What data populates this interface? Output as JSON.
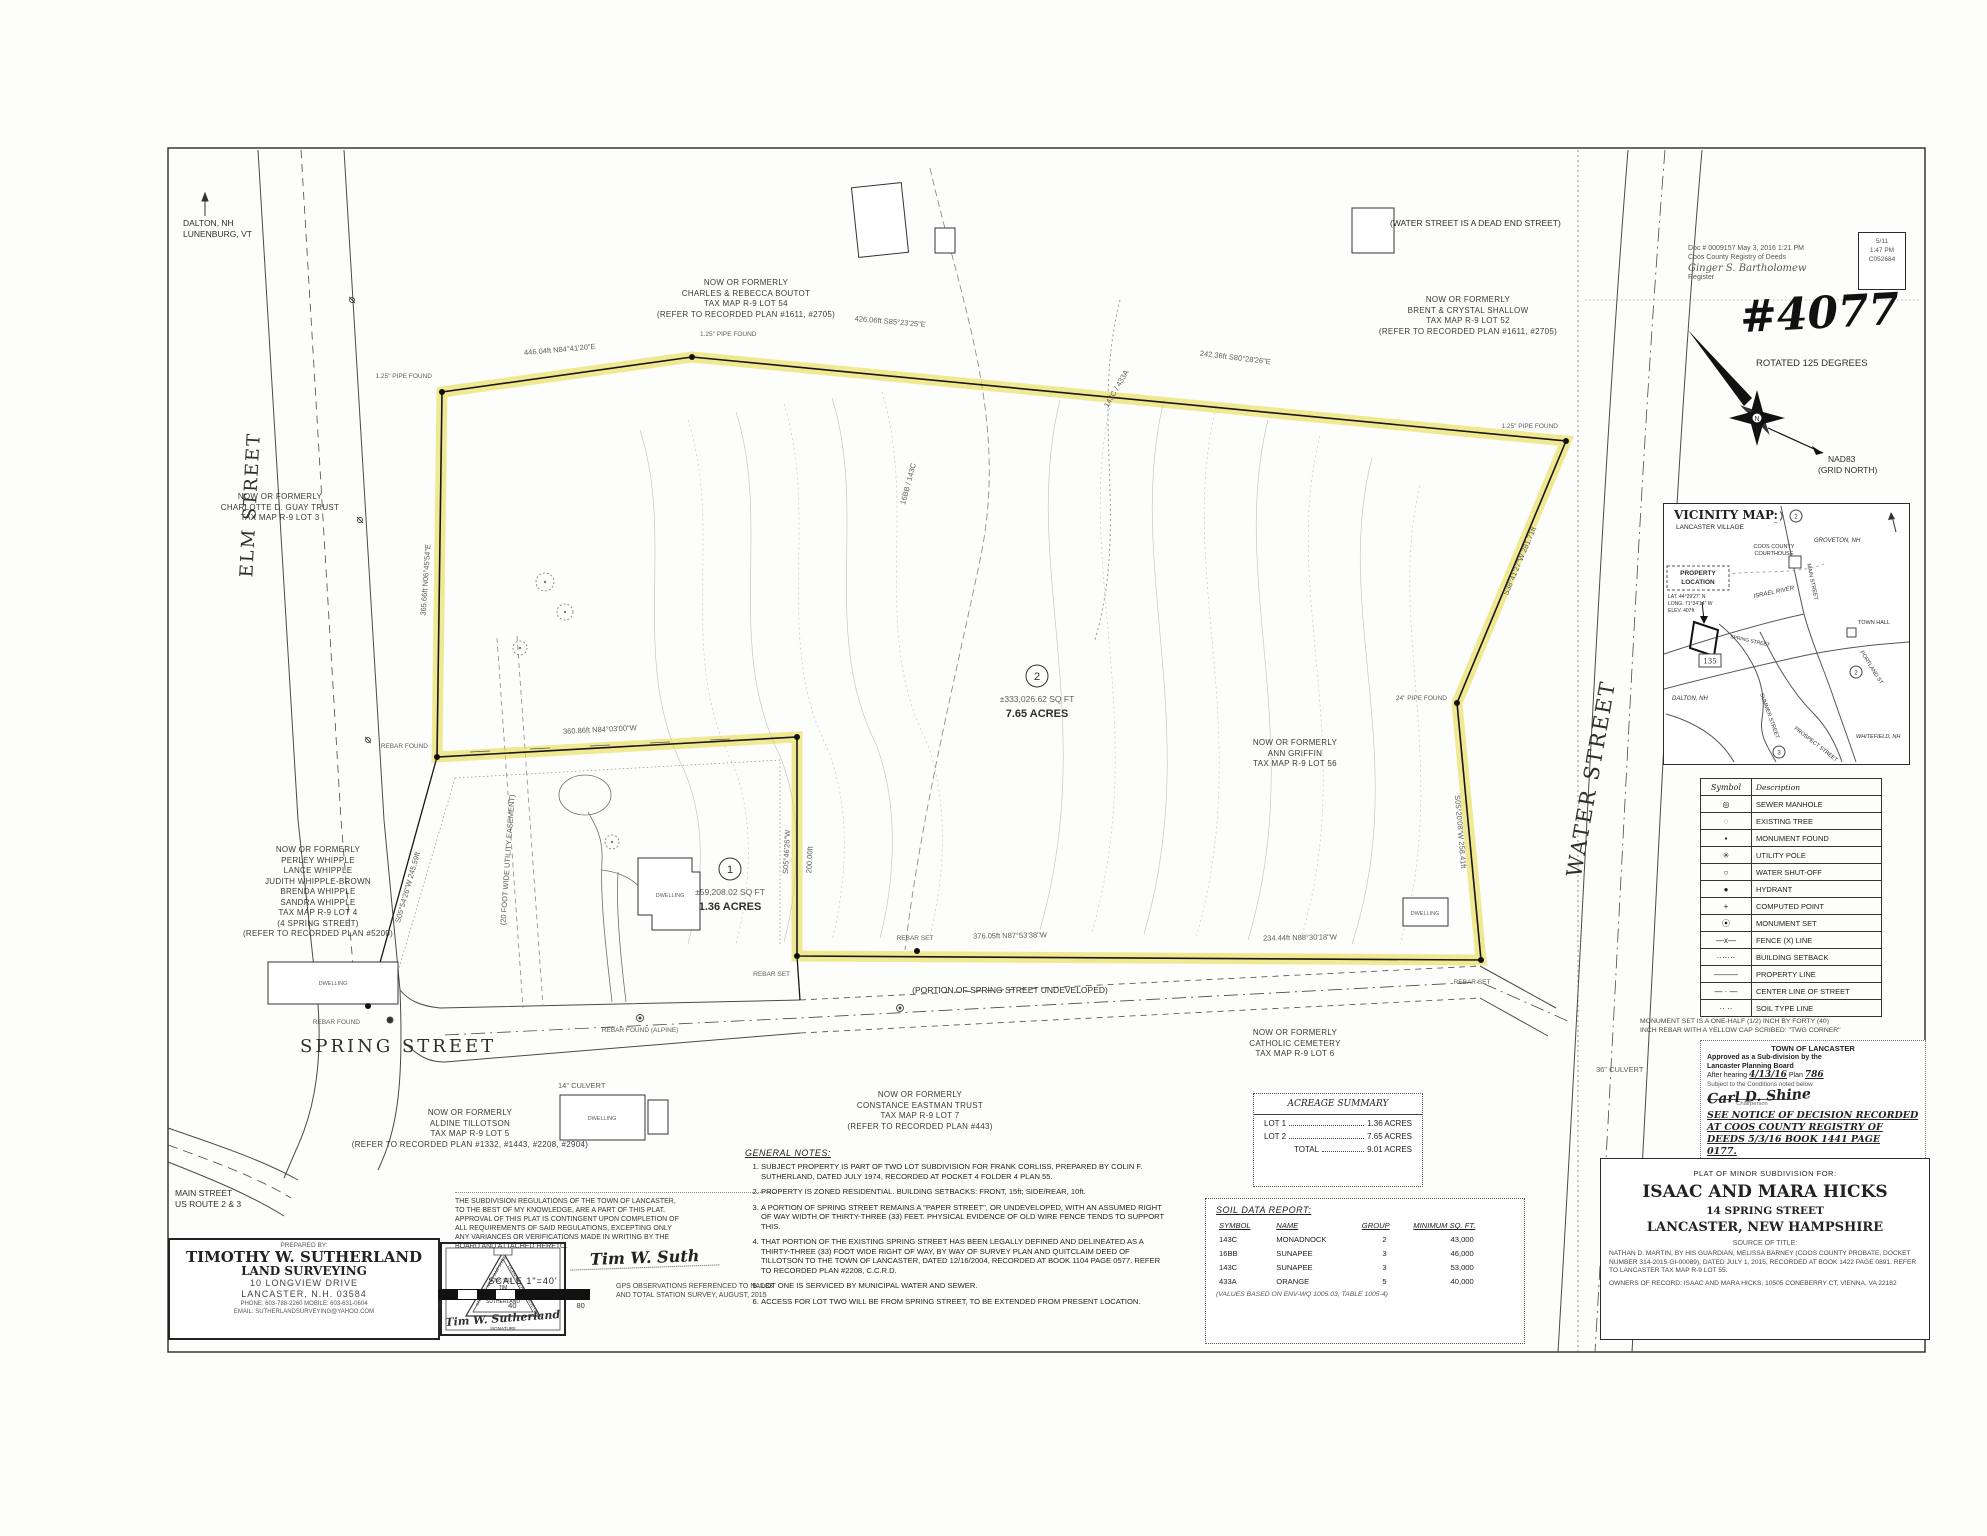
{
  "colors": {
    "boundary_highlight": "#e7d83a",
    "ink": "#1d1d1d"
  },
  "sheet": {
    "number": "#4077",
    "rotation_note": "ROTATED 125 DEGREES",
    "grid_north_1": "NAD83",
    "grid_north_2": "(GRID NORTH)",
    "dead_end_note": "(WATER STREET IS A DEAD END STREET)"
  },
  "stamp": {
    "line1": "Doc # 0009157   May 3, 2016 1:21 PM",
    "line2": "Coos County Registry of Deeds",
    "signature": "Ginger S. Bartholomew",
    "line3": "Register",
    "box": [
      "5/11",
      "1:47 PM",
      "C052684"
    ]
  },
  "map": {
    "streets": {
      "elm": "ELM STREET",
      "water": "WATER STREET",
      "spring": "SPRING STREET",
      "main1": "MAIN STREET",
      "main2": "US ROUTE 2 & 3",
      "spring_undeveloped": "(PORTION OF SPRING STREET UNDEVELOPED)"
    },
    "off_map": {
      "dalton": "DALTON, NH",
      "lunenburg": "LUNENBURG, VT"
    },
    "lot1": {
      "num": "1",
      "sqft": "±59,208.02 SQ FT",
      "acres": "1.36 ACRES"
    },
    "lot2": {
      "num": "2",
      "sqft": "±333,026.62 SQ FT",
      "acres": "7.65 ACRES"
    },
    "easement": "(20 FOOT WIDE UTILITY EASEMENT)",
    "culvert_west": "14\" CULVERT",
    "culvert_east": "36\" CULVERT",
    "soil_label_1": "16BB / 143C",
    "soil_label_2": "143C / 433A",
    "dwelling": "DWELLING",
    "monuments": {
      "a": "1.25\" PIPE FOUND",
      "b": "1.25\" PIPE FOUND",
      "c": "1.25\" PIPE FOUND",
      "d": "24\" PIPE FOUND",
      "e": "REBAR SET",
      "f": "REBAR SET",
      "g": "REBAR SET",
      "i": "REBAR FOUND",
      "j": "REBAR FOUND",
      "mid": "REBAR FOUND (ALPINE)"
    },
    "bearings": {
      "b1": "446.04ft   N84°41'20\"E",
      "b2": "426.06ft   S85°23'25\"E",
      "b3": "242.36ft   S80°28'26\"E",
      "b4": "S38°41'27\"W   281.71ft",
      "b5": "S05°20'08\"W   258.41ft",
      "b6": "234.44ft   N88°30'18\"W",
      "b7": "376.05ft   N87°53'38\"W",
      "b8": "S05°46'26\"W",
      "b9": "200.00ft",
      "b10": "360.86ft   N84°03'00\"W",
      "b11": "365.66ft   N06°45'54\"E",
      "b12": "S05°54'26\"W   245.59ft"
    },
    "neighbors": {
      "guay": [
        "NOW OR FORMERLY",
        "CHARLOTTE D. GUAY TRUST",
        "TAX MAP R-9 LOT 3"
      ],
      "whipple": [
        "NOW OR FORMERLY",
        "PERLEY WHIPPLE",
        "LANCE WHIPPLE",
        "JUDITH WHIPPLE-BROWN",
        "BRENDA WHIPPLE",
        "SANDRA WHIPPLE",
        "TAX MAP R-9 LOT 4",
        "(4 SPRING STREET)",
        "(REFER TO RECORDED PLAN #5200)"
      ],
      "boutot": [
        "NOW OR FORMERLY",
        "CHARLES & REBECCA BOUTOT",
        "TAX MAP R-9 LOT 54",
        "(REFER TO RECORDED PLAN #1611, #2705)"
      ],
      "shallow": [
        "NOW OR FORMERLY",
        "BRENT & CRYSTAL SHALLOW",
        "TAX MAP R-9 LOT 52",
        "(REFER TO RECORDED PLAN #1611, #2705)"
      ],
      "griffin": [
        "NOW OR FORMERLY",
        "ANN GRIFFIN",
        "TAX MAP R-9 LOT 56"
      ],
      "cemetery": [
        "NOW OR FORMERLY",
        "CATHOLIC CEMETERY",
        "TAX MAP R-9 LOT 6"
      ],
      "eastman": [
        "NOW OR FORMERLY",
        "CONSTANCE EASTMAN TRUST",
        "TAX MAP R-9 LOT 7",
        "(REFER TO RECORDED PLAN #443)"
      ],
      "tillotson": [
        "NOW OR FORMERLY",
        "ALDINE TILLOTSON",
        "TAX MAP R-9 LOT 5",
        "(REFER TO RECORDED PLAN #1332, #1443, #2208, #2904)"
      ]
    }
  },
  "vicinity": {
    "title": "VICINITY MAP:",
    "subtitle": "LANCASTER VILLAGE",
    "groveton": "GROVETON, NH",
    "courthouse1": "COOS COUNTY",
    "courthouse2": "COURTHOUSE",
    "river": "ISRAEL RIVER",
    "main_street": "MAIN STREET",
    "town_hall": "TOWN HALL",
    "portland": "PORTLAND ST",
    "prospect": "PROSPECT STREET",
    "summer": "SUMMER STREET",
    "whitefield": "WHITEFIELD, NH",
    "dalton": "DALTON, NH",
    "route135": "135",
    "route3": "3",
    "route2": "2",
    "property1": "PROPERTY",
    "property2": "LOCATION",
    "lat": "LAT. 44°29'27\" N",
    "long": "LONG. 71°34'14\" W",
    "elev": "ELEV. 407ft",
    "spring_st": "SPRING STREET"
  },
  "legend": {
    "header": [
      "Symbol",
      "Description"
    ],
    "rows": [
      {
        "sym": "◎",
        "desc": "SEWER MANHOLE"
      },
      {
        "sym": "◌",
        "desc": "EXISTING TREE"
      },
      {
        "sym": "▪",
        "desc": "MONUMENT FOUND"
      },
      {
        "sym": "✳",
        "desc": "UTILITY POLE"
      },
      {
        "sym": "○",
        "desc": "WATER SHUT-OFF"
      },
      {
        "sym": "●",
        "desc": "HYDRANT"
      },
      {
        "sym": "+",
        "desc": "COMPUTED POINT"
      },
      {
        "sym": "⦿",
        "desc": "MONUMENT SET"
      },
      {
        "sym": "—x—",
        "desc": "FENCE (X) LINE"
      },
      {
        "sym": "·······",
        "desc": "BUILDING SETBACK"
      },
      {
        "sym": "———",
        "desc": "PROPERTY LINE"
      },
      {
        "sym": "— · —",
        "desc": "CENTER LINE OF STREET"
      },
      {
        "sym": "·· ··",
        "desc": "SOIL TYPE LINE"
      }
    ],
    "note1": "MONUMENT SET IS A ONE-HALF (1/2) INCH BY FORTY (40)",
    "note2": "INCH REBAR WITH A YELLOW CAP SCRIBED: \"TWG CORNER\""
  },
  "approval": {
    "town": "TOWN OF LANCASTER",
    "line1": "Approved as a Sub-division by the",
    "line2": "Lancaster Planning Board",
    "line3_pre": "After hearing",
    "line3_date": "4/13/16",
    "line3_mid": "Plan",
    "line3_plan": "786",
    "line4": "Subject to the Conditions noted below",
    "signature": "Carl D. Shine",
    "sig_role": "Chairperson",
    "note_lines": [
      "SEE NOTICE OF DECISION RECORDED",
      "AT COOS COUNTY REGISTRY OF",
      "DEEDS 5/3/16 BOOK 1441 PAGE",
      "0177."
    ]
  },
  "title_block": {
    "kicker": "PLAT OF MINOR SUBDIVISION FOR:",
    "name": "ISAAC AND MARA HICKS",
    "address": "14 SPRING STREET",
    "town": "LANCASTER, NEW HAMPSHIRE",
    "source_label": "SOURCE OF TITLE:",
    "source_text": "NATHAN D. MARTIN, BY HIS GUARDIAN, MELISSA BARNEY (COOS COUNTY PROBATE, DOCKET NUMBER 314-2015-GI-00089), DATED JULY 1, 2015, RECORDED AT BOOK 1422 PAGE 0891. REFER TO LANCASTER TAX MAP R-9 LOT 55.",
    "owners_text": "OWNERS OF RECORD: ISAAC AND MARA HICKS, 10505 CONEBERRY CT, VIENNA, VA 22182"
  },
  "prepared_by": {
    "kicker": "PREPARED BY:",
    "name1": "TIMOTHY W. SUTHERLAND",
    "name2": "LAND SURVEYING",
    "addr1": "10 LONGVIEW DRIVE",
    "addr2": "LANCASTER, N.H. 03584",
    "phone": "PHONE: 603-788-2260      MOBILE: 603-631-0604",
    "email": "EMAIL: SUTHERLANDSURVEYING@YAHOO.COM"
  },
  "seal": {
    "left": "STATE OF NEW HAMPSHIRE",
    "right": "LICENSED LAND SURVEYOR",
    "center": [
      "No. 581",
      "TIM",
      "W.",
      "SUTHERLAND"
    ],
    "sig": "Tim W. Sutherland",
    "label": "SIGNATURE"
  },
  "certification": {
    "lines": [
      "THE SUBDIVISION REGULATIONS OF THE TOWN OF LANCASTER,",
      "TO THE BEST OF MY KNOWLEDGE, ARE A PART OF THIS PLAT.",
      "APPROVAL OF THIS PLAT IS CONTINGENT UPON COMPLETION OF",
      "ALL REQUIREMENTS OF SAID REGULATIONS, EXCEPTING ONLY",
      "ANY VARIANCES OR VERIFICATIONS MADE IN WRITING BY THE",
      "BOARD AND ATTACHED HERETO."
    ],
    "signature": "Tim W. Suth"
  },
  "scale_block": {
    "label": "SCALE   1\"=40'",
    "ticks": [
      "0",
      "40",
      "80"
    ],
    "gps1": "GPS OBSERVATIONS REFERENCED TO NAD83",
    "gps2": "AND TOTAL STATION SURVEY, AUGUST, 2015"
  },
  "general_notes": {
    "title": "GENERAL NOTES:",
    "items": [
      "SUBJECT PROPERTY IS PART OF TWO LOT SUBDIVISION FOR FRANK CORLISS, PREPARED BY COLIN F. SUTHERLAND, DATED JULY 1974, RECORDED AT POCKET 4 FOLDER 4 PLAN 55.",
      "PROPERTY IS ZONED RESIDENTIAL. BUILDING SETBACKS: FRONT, 15ft; SIDE/REAR, 10ft.",
      "A PORTION OF SPRING STREET REMAINS A \"PAPER STREET\", OR UNDEVELOPED, WITH AN ASSUMED RIGHT OF WAY WIDTH OF THIRTY-THREE (33) FEET. PHYSICAL EVIDENCE OF OLD WIRE FENCE TENDS TO SUPPORT THIS.",
      "THAT PORTION OF THE EXISTING SPRING STREET HAS BEEN LEGALLY DEFINED AND DELINEATED AS A THIRTY-THREE (33) FOOT WIDE RIGHT OF WAY, BY WAY OF SURVEY PLAN AND QUITCLAIM DEED OF TILLOTSON TO THE TOWN OF LANCASTER, DATED 12/16/2004, RECORDED AT BOOK 1104 PAGE 0577. REFER TO RECORDED PLAN #2208, C.C.R.D.",
      "LOT ONE IS SERVICED BY MUNICIPAL WATER AND SEWER.",
      "ACCESS FOR LOT TWO WILL BE FROM SPRING STREET, TO BE EXTENDED FROM PRESENT LOCATION."
    ]
  },
  "soil_report": {
    "title": "SOIL DATA REPORT:",
    "headers": [
      "SYMBOL",
      "NAME",
      "GROUP",
      "MINIMUM SQ. FT."
    ],
    "rows": [
      [
        "143C",
        "MONADNOCK",
        "2",
        "43,000"
      ],
      [
        "16BB",
        "SUNAPEE",
        "3",
        "46,000"
      ],
      [
        "143C",
        "SUNAPEE",
        "3",
        "53,000"
      ],
      [
        "433A",
        "ORANGE",
        "5",
        "40,000"
      ]
    ],
    "footnote": "(VALUES BASED ON ENV-WQ 1005.03, TABLE 1005-4)"
  },
  "acreage": {
    "title": "ACREAGE SUMMARY",
    "rows": [
      [
        "LOT 1",
        "1.36 ACRES"
      ],
      [
        "LOT 2",
        "7.65 ACRES"
      ]
    ],
    "total_label": "TOTAL",
    "total": "9.01 ACRES"
  }
}
